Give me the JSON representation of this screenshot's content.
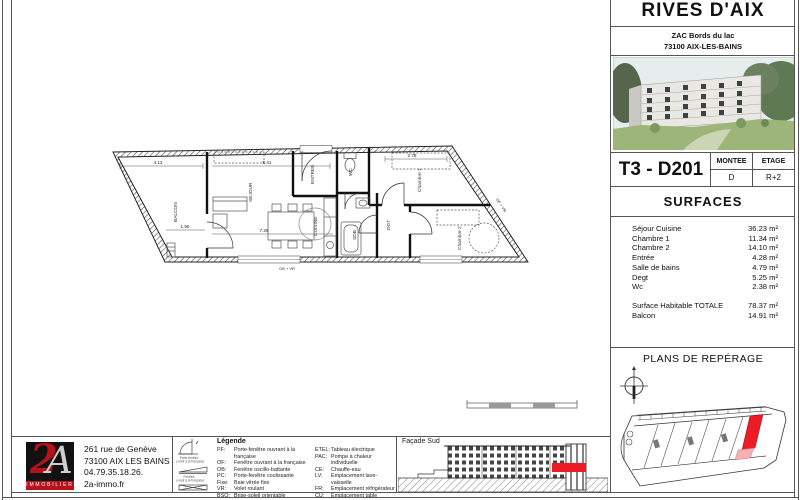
{
  "colors": {
    "accent_red": "#ed1c24",
    "logo_red": "#b5121b",
    "highlight_pink": "#f5b0b6",
    "line": "#444444"
  },
  "header": {
    "project_title": "RIVES D'AIX",
    "address_line1": "ZAC Bords du lac",
    "address_line2": "73100 AIX-LES-BAINS"
  },
  "unit": {
    "code": "T3 - D201",
    "montee_label": "MONTEE",
    "montee_value": "D",
    "etage_label": "ETAGE",
    "etage_value": "R+2"
  },
  "surfaces": {
    "title": "SURFACES",
    "rows": [
      {
        "label": "Séjour Cuisine",
        "value": "36.23 m²"
      },
      {
        "label": "Chambre 1",
        "value": "11.34 m²"
      },
      {
        "label": "Chambre 2",
        "value": "14.10 m²"
      },
      {
        "label": "Entrée",
        "value": "4.28 m²"
      },
      {
        "label": "Salle de bains",
        "value": "4.79 m²"
      },
      {
        "label": "Degt",
        "value": "5.25 m²"
      },
      {
        "label": "Wc",
        "value": "2.38 m²"
      }
    ],
    "totals": [
      {
        "label": "Surface Habitable  TOTALE",
        "value": "78.37 m²"
      },
      {
        "label": "Balcon",
        "value": "14.91 m²"
      }
    ]
  },
  "reperage": {
    "title": "PLANS DE REPÉRAGE"
  },
  "footer": {
    "logo_big": "2",
    "logo_big2": "A",
    "logo_text": "IMMOBILIER",
    "address_line1": "261 rue de Genève",
    "address_line2": "73100 AIX LES BAINS",
    "phone": "04.79.35.18.26.",
    "website": "2a-immo.fr"
  },
  "legend": {
    "title": "Légende",
    "icon_captions": {
      "i1l1": "Porte-fenêtre",
      "i1l2": "ouvrant à la française",
      "i2l1": "Fenêtre",
      "i2l2": "ouvrant à la française"
    },
    "col1": [
      {
        "code": "PF:",
        "label": "Porte-fenêtre ouvrant à la française"
      },
      {
        "code": "OF:",
        "label": "Fenêtre ouvrant à la française"
      },
      {
        "code": "OB:",
        "label": "Fenêtre oscillo-battante"
      },
      {
        "code": "PC:",
        "label": "Porte-fenêtre coulissante"
      },
      {
        "code": "Fixe:",
        "label": "Baie vitrée fixe"
      },
      {
        "code": "VR:",
        "label": "Volet roulant"
      },
      {
        "code": "BSO:",
        "label": "Brise-soleil orientable"
      }
    ],
    "col2": [
      {
        "code": "ETEL:",
        "label": "Tableau électrique"
      },
      {
        "code": "PAC:",
        "label": "Pompe à chaleur individuelle"
      },
      {
        "code": "CE:",
        "label": "Chauffe-eau"
      },
      {
        "code": "LV:",
        "label": "Emplacement lave-vaisselle"
      },
      {
        "code": "FR:",
        "label": "Emplacement réfrigérateur"
      },
      {
        "code": "CU:",
        "label": "Emplacement table cuisson"
      },
      {
        "code": "LL:",
        "label": "Emplacement Lave-linge"
      }
    ]
  },
  "facade": {
    "title": "Façade Sud"
  },
  "plan": {
    "rooms": {
      "balcon": "BALCON",
      "sejour": "SEJOUR",
      "cuisine": "CUISINE",
      "chambre1": "Chambre 1",
      "chambre2": "Chambre 2",
      "sdb": "SDB",
      "wc": "WC",
      "entree": "ENTREE",
      "dgt": "DGT"
    },
    "dims": {
      "d1": "4.13",
      "d2": "5.41",
      "d3": "1.90",
      "d4": "2.79",
      "d5": "7.26"
    },
    "annotations": {
      "window1": "OB + VR",
      "window2": "OF + VR"
    }
  }
}
